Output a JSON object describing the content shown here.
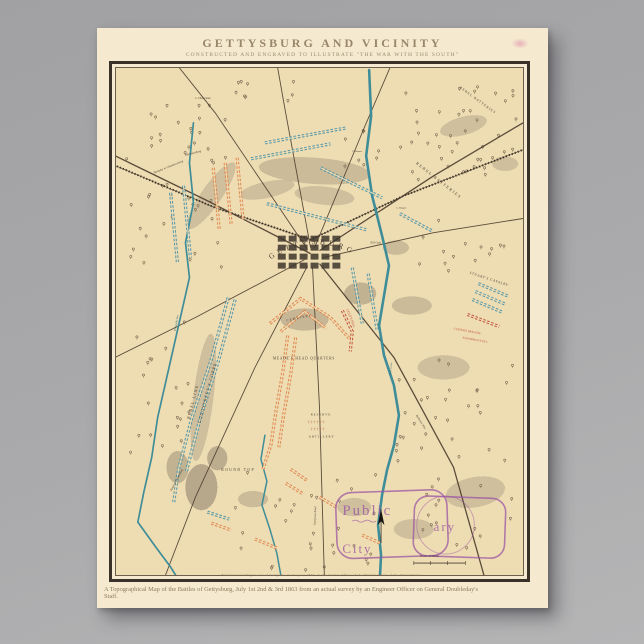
{
  "poster": {
    "title": "GETTYSBURG AND VICINITY",
    "subtitle": "CONSTRUCTED AND ENGRAVED TO ILLUSTRATE \"THE WAR WITH THE SOUTH\"",
    "imprint": "Entered according to Act of Congress, in the year 1863, in the Clerk's Office of the District Court of the United States.",
    "caption": "A Topographical Map of the Battles of Gettysburg, July 1st 2nd & 3rd 1863 from an actual survey by an Engineer Officer on General Doubleday's",
    "caption_line2": "Staff.",
    "paper_color": "#f5ead0",
    "map_paper_color": "#eedcb3"
  },
  "map": {
    "colors": {
      "road": "#4a3c2c",
      "railroad": "#3d3226",
      "water": "#3e8d98",
      "water_dark": "#356d76",
      "union": "#e0834a",
      "rebel": "#4a93a8",
      "red_label": "#c04f38",
      "artillery": "#b5653c",
      "hill": "#8a7e6b",
      "ink": "#4a3f30",
      "tree": "#7a6950",
      "stamp": "#9b57a3",
      "town": "#3e362c"
    },
    "town_label": "GETTYSBURG",
    "scale_label": "Scale of Miles",
    "stamp": {
      "word1": "Public",
      "word2": "ary",
      "word3": "City"
    },
    "labels": [
      {
        "t": "REBEL  BATTERIES",
        "x": 302,
        "y": 96,
        "r": 38,
        "s": 4,
        "ls": 1.5
      },
      {
        "t": "REBEL  BATTERIES",
        "x": 346,
        "y": 20,
        "r": 36,
        "s": 3.4,
        "ls": 1
      },
      {
        "t": "REBEL LINE",
        "x": 74,
        "y": 352,
        "r": -75,
        "s": 4.2,
        "ls": 1.2
      },
      {
        "t": "LONGSTREET'S  CORPS",
        "x": 85,
        "y": 356,
        "r": -75,
        "s": 4.2,
        "ls": 1
      },
      {
        "t": "MEADE'S HEAD QUARTERS",
        "x": 158,
        "y": 292,
        "s": 3.6,
        "ls": 0.8
      },
      {
        "t": "CEMETERY",
        "x": 172,
        "y": 254,
        "r": -12,
        "s": 3.4,
        "ls": 1
      },
      {
        "t": "CULP'S HILL",
        "x": 232,
        "y": 242,
        "r": 68,
        "s": 3.4,
        "c": "red_label"
      },
      {
        "t": "STUART'S  CAVALRY",
        "x": 356,
        "y": 206,
        "r": 18,
        "s": 3.4,
        "ls": 0.6
      },
      {
        "t": "CUSTER'S BRIGADE",
        "x": 340,
        "y": 262,
        "r": 10,
        "s": 3,
        "c": "red_label"
      },
      {
        "t": "KILPATRICK'S DIV.",
        "x": 349,
        "y": 271,
        "r": 10,
        "s": 3,
        "c": "red_label"
      },
      {
        "t": "ROUND TOP",
        "x": 106,
        "y": 404,
        "s": 3.8,
        "ls": 1.4
      },
      {
        "t": "RESERVE",
        "x": 196,
        "y": 348,
        "s": 3.2,
        "ls": 1
      },
      {
        "t": "† † † † † †",
        "x": 193,
        "y": 356,
        "s": 4,
        "c": "artillery"
      },
      {
        "t": "† † † † †",
        "x": 196,
        "y": 363,
        "s": 4,
        "c": "artillery"
      },
      {
        "t": "ARTILLERY",
        "x": 194,
        "y": 370,
        "s": 3.2,
        "ls": 1
      },
      {
        "t": "Toll Gate",
        "x": 256,
        "y": 176,
        "s": 3,
        "i": 1
      },
      {
        "t": "Road to Emmitsburg",
        "x": 56,
        "y": 424,
        "r": -62,
        "s": 3,
        "i": 1
      },
      {
        "t": "Turnpike to Chambersburg",
        "x": 38,
        "y": 106,
        "r": -22,
        "s": 3,
        "i": 1
      },
      {
        "t": "Mummasburg",
        "x": 70,
        "y": 88,
        "r": -14,
        "s": 3,
        "i": 1
      },
      {
        "t": "L. Dickerman",
        "x": 80,
        "y": 31,
        "s": 2.8,
        "i": 1
      },
      {
        "t": "Rock Creek",
        "x": 277,
        "y": 308,
        "r": -85,
        "s": 2.8,
        "i": 1,
        "c": "water_dark"
      },
      {
        "t": "Willoughby Run",
        "x": 60,
        "y": 264,
        "r": -80,
        "s": 2.6,
        "i": 1,
        "c": "water_dark"
      },
      {
        "t": "Baltimore Pike",
        "x": 302,
        "y": 348,
        "r": 58,
        "s": 2.8,
        "i": 1
      },
      {
        "t": "Taneytown Road",
        "x": 201,
        "y": 458,
        "r": -88,
        "s": 2.8,
        "i": 1
      },
      {
        "t": "A. Heagen",
        "x": 282,
        "y": 141,
        "s": 2.5,
        "i": 1
      },
      {
        "t": "C. Benner",
        "x": 238,
        "y": 84,
        "s": 2.5,
        "i": 1
      }
    ],
    "roads": [
      {
        "p": [
          [
            196,
            186
          ],
          [
            90,
            132
          ],
          [
            -5,
            86
          ]
        ],
        "w": 1.3
      },
      {
        "p": [
          [
            193,
            182
          ],
          [
            100,
            45
          ],
          [
            60,
            -5
          ]
        ],
        "w": 0.9
      },
      {
        "p": [
          [
            196,
            180
          ],
          [
            170,
            40
          ],
          [
            162,
            -5
          ]
        ],
        "w": 0.9
      },
      {
        "p": [
          [
            200,
            180
          ],
          [
            250,
            60
          ],
          [
            278,
            -5
          ]
        ],
        "w": 0.9
      },
      {
        "p": [
          [
            205,
            183
          ],
          [
            320,
            108
          ],
          [
            415,
            52
          ]
        ],
        "w": 1.3
      },
      {
        "p": [
          [
            208,
            190
          ],
          [
            320,
            165
          ],
          [
            415,
            150
          ]
        ],
        "w": 0.9
      },
      {
        "p": [
          [
            205,
            196
          ],
          [
            280,
            290
          ],
          [
            340,
            400
          ],
          [
            372,
            513
          ]
        ],
        "w": 1.3
      },
      {
        "p": [
          [
            198,
            200
          ],
          [
            205,
            340
          ],
          [
            210,
            513
          ]
        ],
        "w": 0.9
      },
      {
        "p": [
          [
            193,
            198
          ],
          [
            140,
            300
          ],
          [
            80,
            430
          ],
          [
            48,
            513
          ]
        ],
        "w": 0.9
      },
      {
        "p": [
          [
            190,
            192
          ],
          [
            80,
            250
          ],
          [
            -5,
            292
          ]
        ],
        "w": 0.9
      }
    ],
    "railroad": {
      "p": [
        [
          -5,
          96
        ],
        [
          100,
          140
        ],
        [
          196,
          172
        ],
        [
          290,
          128
        ],
        [
          415,
          80
        ]
      ]
    },
    "creeks": [
      {
        "p": [
          [
            255,
            2
          ],
          [
            257,
            48
          ],
          [
            252,
            88
          ],
          [
            258,
            128
          ],
          [
            268,
            168
          ],
          [
            275,
            198
          ],
          [
            270,
            228
          ],
          [
            265,
            258
          ],
          [
            270,
            288
          ],
          [
            280,
            318
          ],
          [
            285,
            348
          ],
          [
            280,
            378
          ],
          [
            273,
            403
          ],
          [
            268,
            428
          ],
          [
            264,
            458
          ],
          [
            267,
            488
          ],
          [
            266,
            508
          ]
        ],
        "w": 2.6
      },
      {
        "p": [
          [
            78,
            55
          ],
          [
            74,
            95
          ],
          [
            78,
            135
          ],
          [
            70,
            175
          ],
          [
            74,
            210
          ],
          [
            66,
            245
          ],
          [
            58,
            280
          ],
          [
            50,
            315
          ],
          [
            42,
            350
          ],
          [
            36,
            390
          ],
          [
            28,
            425
          ],
          [
            22,
            455
          ],
          [
            40,
            480
          ],
          [
            55,
            500
          ],
          [
            60,
            508
          ]
        ],
        "w": 1.7
      },
      {
        "p": [
          [
            150,
            368
          ],
          [
            146,
            392
          ],
          [
            152,
            414
          ],
          [
            147,
            438
          ],
          [
            155,
            462
          ],
          [
            162,
            486
          ],
          [
            166,
            508
          ]
        ],
        "w": 1.5
      }
    ],
    "troop_lines": [
      {
        "s": "r",
        "p": [
          [
            55,
            125
          ],
          [
            62,
            196
          ]
        ]
      },
      {
        "s": "r",
        "p": [
          [
            68,
            118
          ],
          [
            75,
            190
          ]
        ]
      },
      {
        "s": "r",
        "p": [
          [
            150,
            75
          ],
          [
            232,
            60
          ]
        ]
      },
      {
        "s": "r",
        "p": [
          [
            136,
            91
          ],
          [
            216,
            76
          ]
        ]
      },
      {
        "s": "r",
        "p": [
          [
            206,
            100
          ],
          [
            268,
            130
          ]
        ]
      },
      {
        "s": "r",
        "p": [
          [
            152,
            136
          ],
          [
            252,
            162
          ]
        ]
      },
      {
        "s": "r",
        "p": [
          [
            286,
            146
          ],
          [
            318,
            163
          ]
        ]
      },
      {
        "s": "r",
        "p": [
          [
            238,
            200
          ],
          [
            248,
            256
          ]
        ]
      },
      {
        "s": "r",
        "p": [
          [
            254,
            206
          ],
          [
            263,
            262
          ]
        ]
      },
      {
        "s": "r",
        "p": [
          [
            113,
            230
          ],
          [
            96,
            292
          ],
          [
            76,
            352
          ],
          [
            63,
            402
          ],
          [
            58,
            436
          ]
        ]
      },
      {
        "s": "r",
        "p": [
          [
            120,
            232
          ],
          [
            103,
            294
          ],
          [
            84,
            354
          ],
          [
            71,
            404
          ]
        ]
      },
      {
        "s": "r",
        "p": [
          [
            365,
            216
          ],
          [
            396,
            229
          ]
        ]
      },
      {
        "s": "r",
        "p": [
          [
            362,
            224
          ],
          [
            393,
            237
          ]
        ]
      },
      {
        "s": "r",
        "p": [
          [
            359,
            232
          ],
          [
            390,
            245
          ]
        ]
      },
      {
        "s": "r",
        "p": [
          [
            92,
            445
          ],
          [
            114,
            452
          ]
        ]
      },
      {
        "s": "u",
        "p": [
          [
            98,
            100
          ],
          [
            104,
            162
          ]
        ]
      },
      {
        "s": "u",
        "p": [
          [
            110,
            95
          ],
          [
            116,
            157
          ]
        ]
      },
      {
        "s": "u",
        "p": [
          [
            122,
            90
          ],
          [
            128,
            152
          ]
        ]
      },
      {
        "s": "u",
        "p": [
          [
            155,
            256
          ],
          [
            186,
            231
          ],
          [
            216,
            250
          ],
          [
            236,
            272
          ]
        ]
      },
      {
        "s": "u",
        "p": [
          [
            166,
            264
          ],
          [
            190,
            244
          ],
          [
            212,
            261
          ]
        ]
      },
      {
        "s": "u",
        "p": [
          [
            173,
            268
          ],
          [
            168,
            305
          ],
          [
            161,
            345
          ],
          [
            156,
            378
          ],
          [
            148,
            402
          ]
        ]
      },
      {
        "s": "u",
        "p": [
          [
            181,
            270
          ],
          [
            176,
            307
          ],
          [
            169,
            347
          ],
          [
            164,
            380
          ]
        ]
      },
      {
        "s": "c",
        "p": [
          [
            228,
            243
          ],
          [
            238,
            264
          ],
          [
            236,
            284
          ]
        ]
      },
      {
        "s": "u",
        "p": [
          [
            176,
            402
          ],
          [
            192,
            413
          ]
        ]
      },
      {
        "s": "u",
        "p": [
          [
            171,
            416
          ],
          [
            189,
            427
          ]
        ]
      },
      {
        "s": "u",
        "p": [
          [
            96,
            456
          ],
          [
            116,
            463
          ]
        ]
      },
      {
        "s": "u",
        "p": [
          [
            140,
            472
          ],
          [
            162,
            481
          ]
        ]
      },
      {
        "s": "c",
        "p": [
          [
            354,
            247
          ],
          [
            386,
            259
          ]
        ]
      },
      {
        "s": "u",
        "p": [
          [
            205,
            430
          ],
          [
            222,
            440
          ]
        ]
      },
      {
        "s": "u",
        "p": [
          [
            248,
            468
          ],
          [
            266,
            476
          ]
        ]
      }
    ],
    "hills": [
      [
        200,
        103,
        56,
        13,
        4,
        0.35
      ],
      [
        152,
        122,
        28,
        8,
        -12,
        0.3
      ],
      [
        96,
        128,
        40,
        10,
        -55,
        0.3
      ],
      [
        210,
        128,
        30,
        9,
        6,
        0.3
      ],
      [
        190,
        252,
        24,
        11,
        0,
        0.4
      ],
      [
        246,
        226,
        16,
        11,
        0,
        0.45
      ],
      [
        298,
        238,
        20,
        9,
        0,
        0.35
      ],
      [
        282,
        180,
        13,
        7,
        0,
        0.35
      ],
      [
        350,
        58,
        24,
        9,
        -15,
        0.3
      ],
      [
        392,
        96,
        13,
        7,
        0,
        0.3
      ],
      [
        88,
        330,
        10,
        64,
        7,
        0.3
      ],
      [
        86,
        420,
        16,
        23,
        0,
        0.55
      ],
      [
        102,
        391,
        10,
        12,
        0,
        0.5
      ],
      [
        330,
        300,
        26,
        12,
        0,
        0.3
      ],
      [
        362,
        425,
        30,
        15,
        -10,
        0.3
      ],
      [
        300,
        462,
        20,
        10,
        0,
        0.3
      ],
      [
        240,
        440,
        17,
        9,
        0,
        0.3
      ],
      [
        138,
        432,
        15,
        8,
        0,
        0.35
      ],
      [
        62,
        400,
        11,
        16,
        0,
        0.45
      ]
    ],
    "tree_clusters": [
      [
        8,
        35,
        105,
        170,
        46
      ],
      [
        118,
        8,
        70,
        30,
        9
      ],
      [
        285,
        12,
        118,
        100,
        42
      ],
      [
        300,
        148,
        100,
        60,
        14
      ],
      [
        282,
        292,
        120,
        190,
        46
      ],
      [
        118,
        398,
        145,
        105,
        30
      ],
      [
        8,
        245,
        70,
        140,
        20
      ],
      [
        230,
        55,
        40,
        50,
        8
      ]
    ],
    "town": {
      "x": 163,
      "y": 168,
      "cols": 6,
      "rows": 4,
      "bw": 8,
      "bh": 6,
      "gx": 3,
      "gy": 3
    },
    "compass": {
      "x": 267,
      "y": 456
    }
  }
}
